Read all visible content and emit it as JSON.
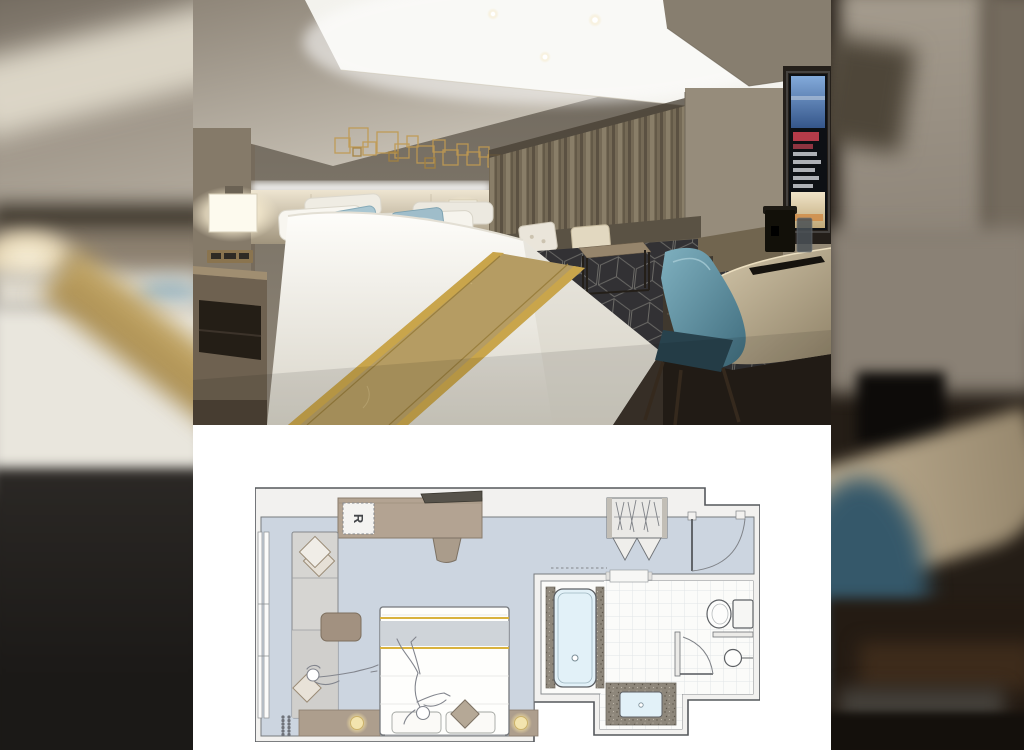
{
  "gallery": {
    "layout": "photo-over-floor-plan-on-blurred-backdrop",
    "photo": {
      "subject": "Hotel guest room: king bed with gold runner and blue accent pillows, lit ceiling cove, gold wire wall art, bedside sconces, curtains, wall TV, marble desk with coffee machine, teal chair, dark geometric carpet",
      "colors": {
        "ceiling": "#d6d0c4",
        "wall": "#7e7669",
        "cove_light": "#f3f2ed",
        "gold_art": "#c09a52",
        "headboard": "#c9bda4",
        "curtain": "#756a56",
        "bed": "#f6f4ee",
        "runner": "#b59c63",
        "runner_edge": "#c9a54b",
        "pillow_blue": "#a9c6d1",
        "sofa": "#5a5244",
        "carpet": "#323134",
        "carpet_lines": "#807e79",
        "marble": "#c2b295",
        "chair_teal": "#5a8c9e",
        "tv_screen_blue": "#5d87c2",
        "tv_screen_red": "#b43b49",
        "sconce": "#fdfaee"
      }
    },
    "floor_plan": {
      "fridge_label": "R",
      "colors": {
        "floor": "#ccd5e0",
        "wall": "#f2f1ef",
        "outline": "#55585c",
        "furniture": "#b3a392",
        "bench": "#d6d5d2",
        "granite": "#8e877b",
        "water": "#e2f1f8",
        "gold": "#d9b23e",
        "lamp": "#f3e4ae",
        "tile": "#fbfbf9"
      },
      "fixtures": [
        "window",
        "chaise-sofa",
        "throw-pillows",
        "coffee-table",
        "desk-counter",
        "refrigerator",
        "tv",
        "desk-chair",
        "double-bed",
        "bed-runner",
        "bed-pillows",
        "bedside-lamps",
        "wardrobe",
        "entrance-door",
        "bathtub",
        "vanity-sink",
        "toilet",
        "washbasin",
        "shower-room-door",
        "figure-lounging-on-sofa",
        "figure-lying-on-bed"
      ]
    }
  }
}
